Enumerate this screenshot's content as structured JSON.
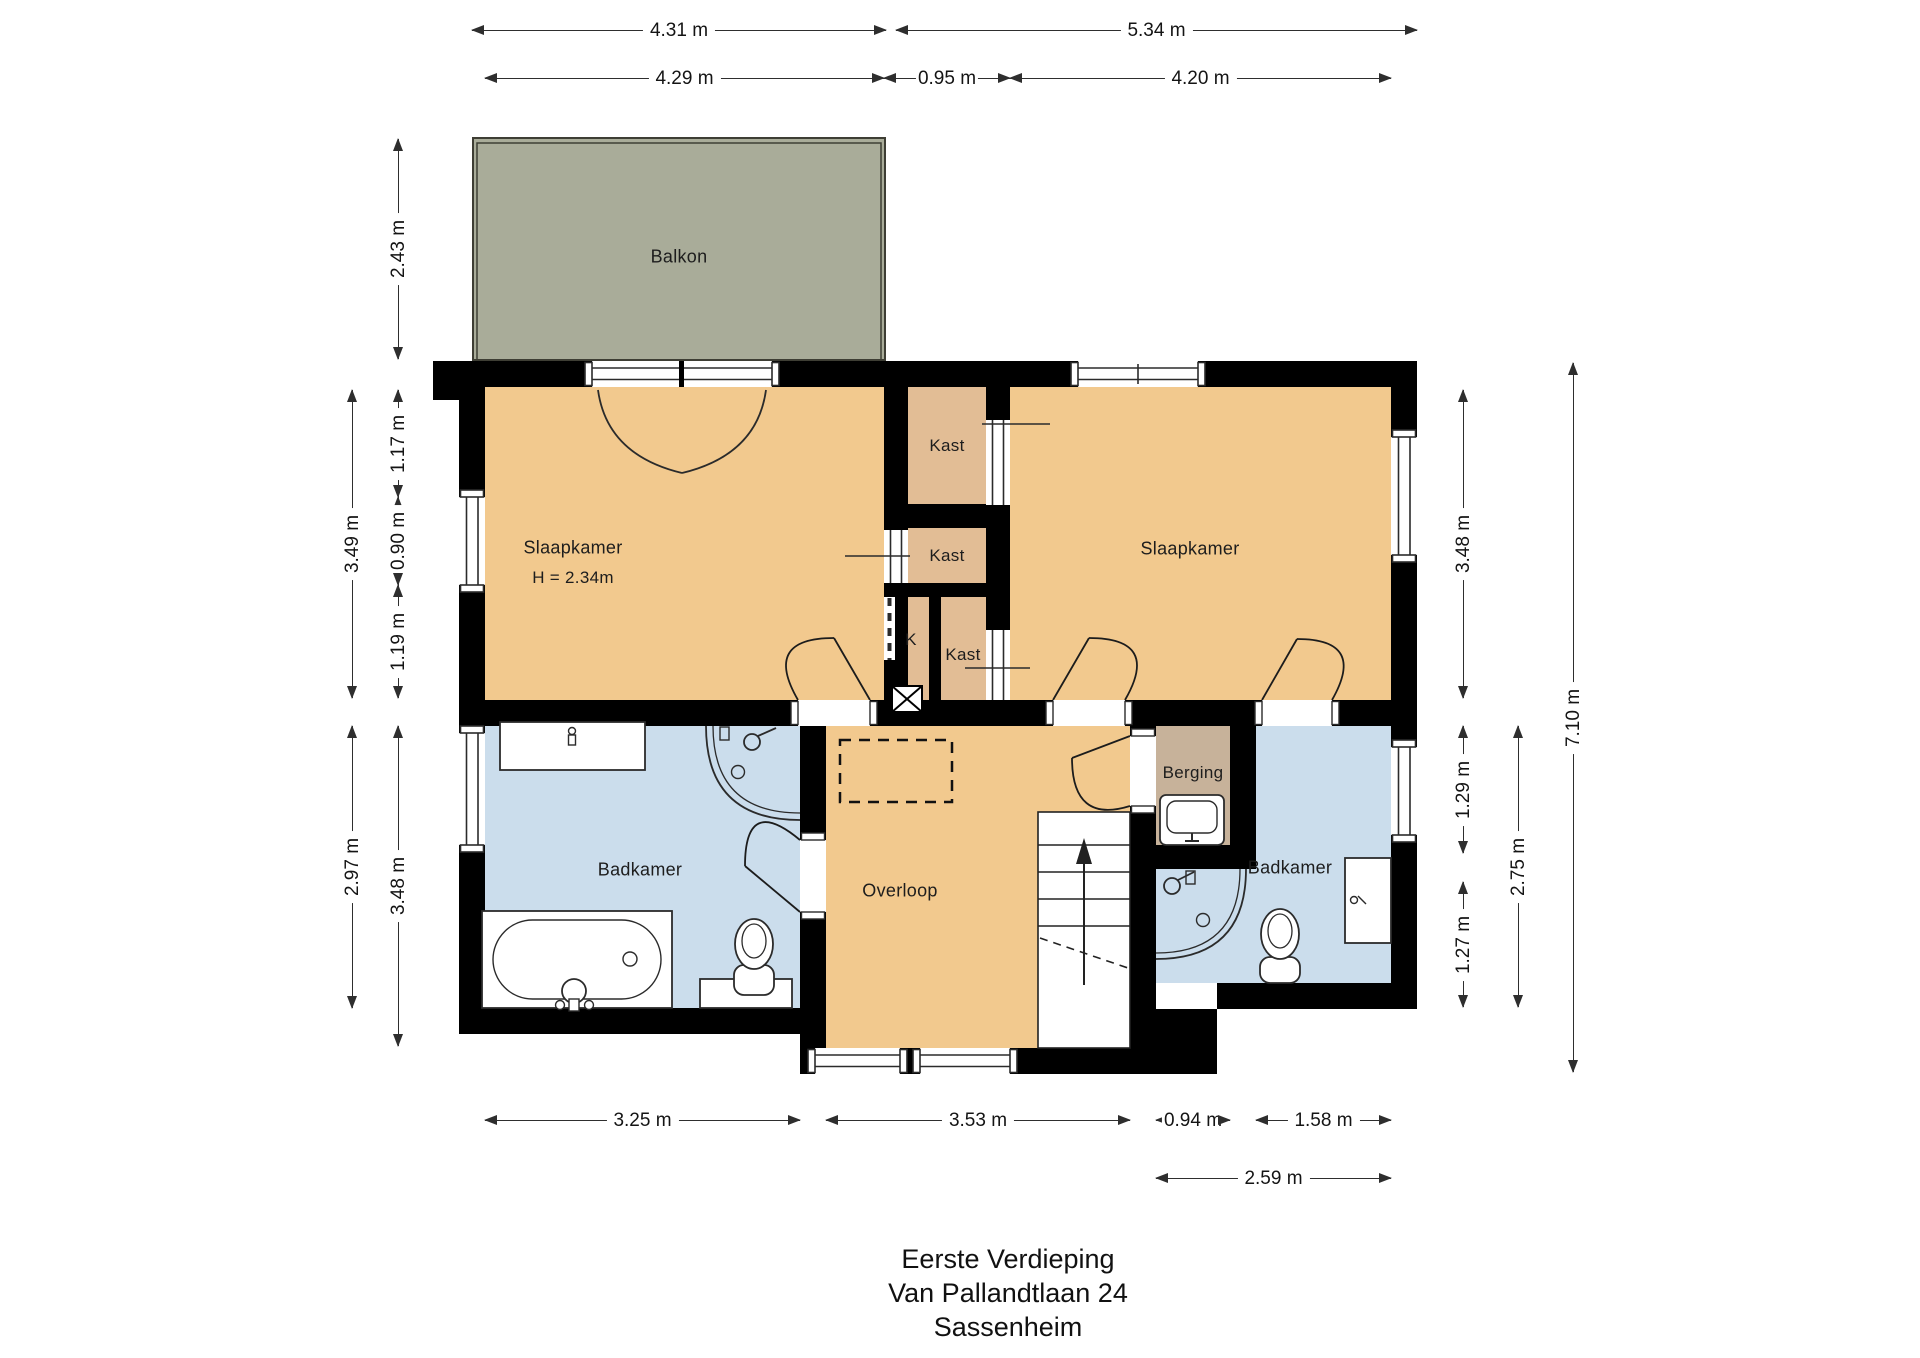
{
  "title": {
    "line1": "Eerste Verdieping",
    "line2": "Van Pallandtlaan 24",
    "line3": "Sassenheim"
  },
  "rooms": {
    "balkon": {
      "label": "Balkon"
    },
    "slaapkamer_left": {
      "label": "Slaapkamer",
      "height_note": "H = 2.34m"
    },
    "slaapkamer_right": {
      "label": "Slaapkamer"
    },
    "kast1": {
      "label": "Kast"
    },
    "kast2": {
      "label": "Kast"
    },
    "kast3": {
      "label": "Kast"
    },
    "k": {
      "label": "K"
    },
    "badkamer_left": {
      "label": "Badkamer"
    },
    "overloop": {
      "label": "Overloop"
    },
    "berging": {
      "label": "Berging"
    },
    "badkamer_right": {
      "label": "Badkamer"
    }
  },
  "dims": {
    "w_balkon": "4.31 m",
    "w_main_right": "5.34 m",
    "w_slaapkamer_left": "4.29 m",
    "w_kast_zone": "0.95 m",
    "w_slaapkamer_right": "4.20 m",
    "h_balkon": "2.43 m",
    "h_slaap_upper": "3.49 m",
    "h_wall_to_window": "1.17 m",
    "h_window": "0.90 m",
    "h_window_to_wall": "1.19 m",
    "h_badkamer_left": "2.97 m",
    "h_lower_left": "3.48 m",
    "h_slaap_right": "3.48 m",
    "h_berging": "1.29 m",
    "h_badkamer_right": "1.27 m",
    "h_lower_right": "2.75 m",
    "h_total_right": "7.10 m",
    "w_badkamer_left": "3.25 m",
    "w_overloop": "3.53 m",
    "w_berging": "0.94 m",
    "w_badkamer_right": "1.58 m",
    "w_berging_badkamer": "2.59 m"
  },
  "colors": {
    "bedroom_orange": "#F2C98E",
    "closet_tan": "#E2BD95",
    "bathroom_blue": "#CBDDEC",
    "balcony_green": "#A9AC99",
    "berging_brown": "#C7B29A",
    "wall_black": "#000000"
  }
}
